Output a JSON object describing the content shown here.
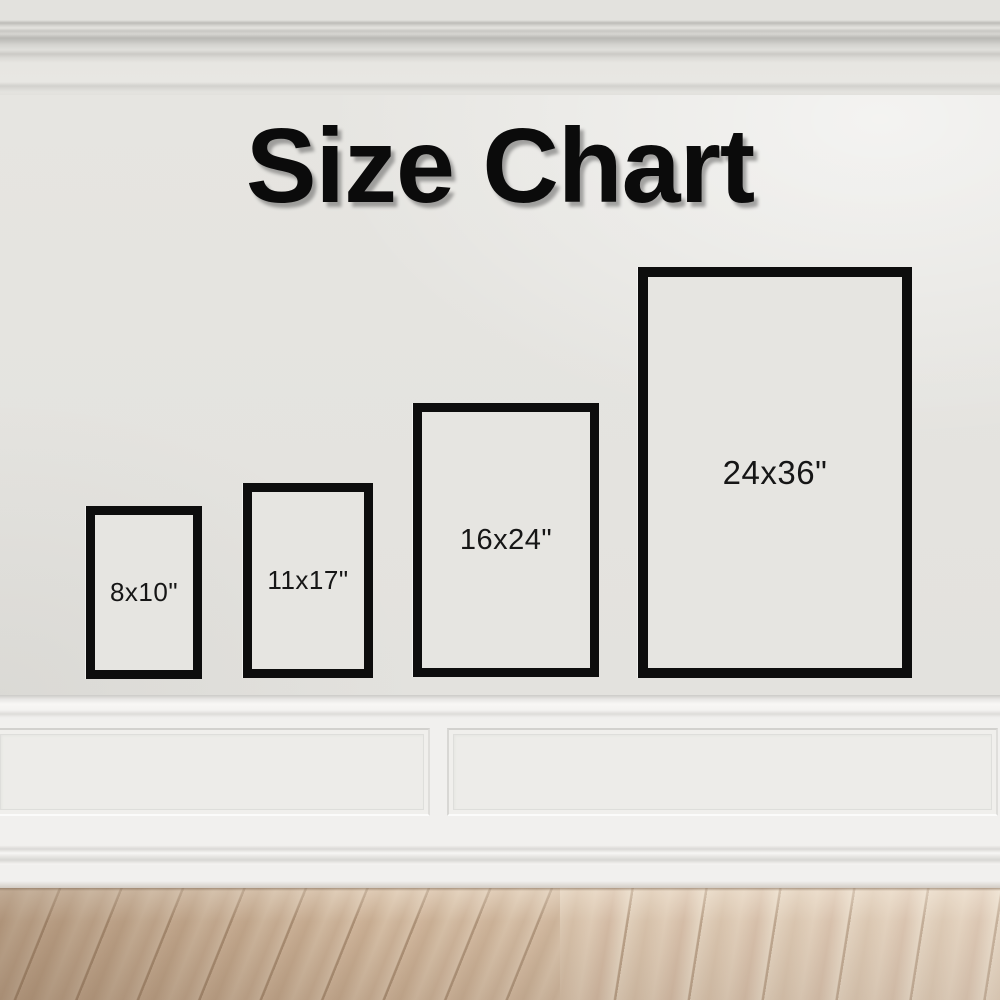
{
  "scene": {
    "title": "Size Chart",
    "setting": "white wall with crown molding, wainscot panels and light wood floor"
  },
  "frames": [
    {
      "id": "frame-8x10",
      "label": "8x10\"",
      "width_in": 8,
      "height_in": 10
    },
    {
      "id": "frame-11x17",
      "label": "11x17\"",
      "width_in": 11,
      "height_in": 17
    },
    {
      "id": "frame-16x24",
      "label": "16x24\"",
      "width_in": 16,
      "height_in": 24
    },
    {
      "id": "frame-24x36",
      "label": "24x36\"",
      "width_in": 24,
      "height_in": 36
    }
  ],
  "colors": {
    "wall": "#e6e5e1",
    "wainscot": "#f1f0ee",
    "frame_border": "#0d0d0d",
    "frame_fill": "#e6e5e1",
    "title_text": "#0b0b0b",
    "label_text": "#161616",
    "floor_light": "#dcc9b3",
    "floor_dark": "#b89d83"
  }
}
